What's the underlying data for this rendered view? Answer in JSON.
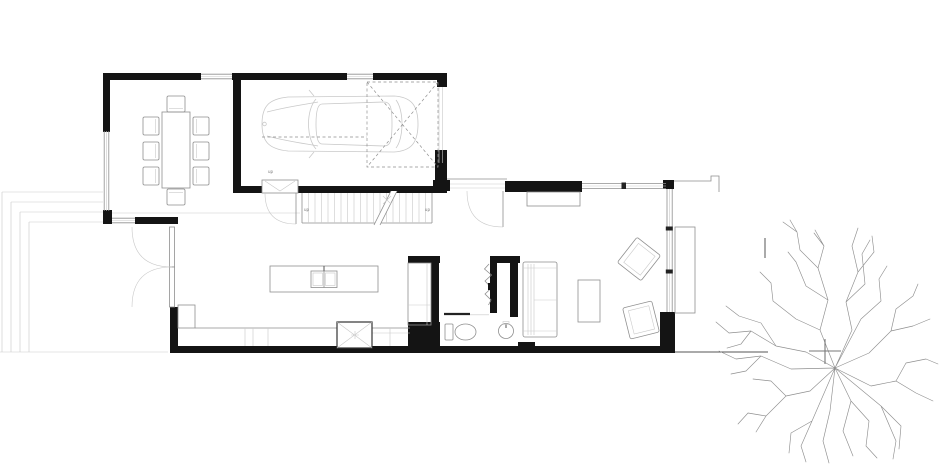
{
  "document": {
    "title": "Ground floor plan",
    "type": "architectural floor plan line drawing, black walls on white"
  },
  "colors": {
    "wall": "#141414",
    "line": "#8f8f8f",
    "line_light": "#c9c9c9",
    "line_dark": "#555555",
    "bg": "#ffffff"
  },
  "labels": {
    "garage_door_step": "up",
    "stair_bottom": "up",
    "stair_top": "up"
  },
  "symbols": [
    "dining-table",
    "dining-chair x8",
    "car-plan-view",
    "garage-door-dashed-panel",
    "staircase",
    "kitchen-island",
    "double-bowl-sink",
    "counter-run",
    "cooktop",
    "tall-cabinet",
    "pocket-door",
    "toilet",
    "round-basin",
    "accordion-door",
    "french-doors",
    "entry-door-swing",
    "hall-door-swing",
    "sofa",
    "coffee-table",
    "armchair x2",
    "sideboard",
    "terrace-steps",
    "tree-plan-symbol"
  ]
}
